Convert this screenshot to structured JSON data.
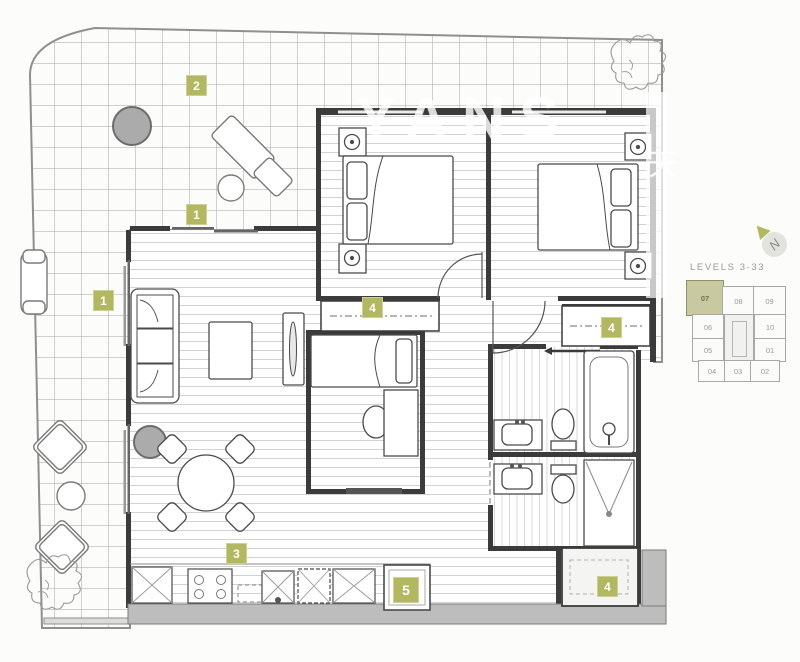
{
  "plan": {
    "badges": [
      {
        "label": "2"
      },
      {
        "label": "1"
      },
      {
        "label": "1"
      },
      {
        "label": "3"
      },
      {
        "label": "4"
      },
      {
        "label": "4"
      },
      {
        "label": "4"
      },
      {
        "label": "5"
      }
    ],
    "keyplan": {
      "levels_label": "LEVELS 3-33",
      "north_label": "N",
      "highlighted_unit": "07",
      "units": {
        "u07": "07",
        "u08": "08",
        "u09": "09",
        "u06": "06",
        "u10": "10",
        "u05": "05",
        "u01": "01",
        "u04": "04",
        "u03": "03",
        "u02": "02"
      }
    },
    "watermark": {
      "text": "YANS",
      "cjk": "天"
    },
    "colors": {
      "badge_olive": "#b2b860",
      "keyplan_highlight": "#c8c9a0",
      "wall": "#3b3b3b",
      "grid_line": "#a3a3a3",
      "plank_line": "#d2d2d2",
      "gray_fill": "#bdbdbd"
    }
  }
}
